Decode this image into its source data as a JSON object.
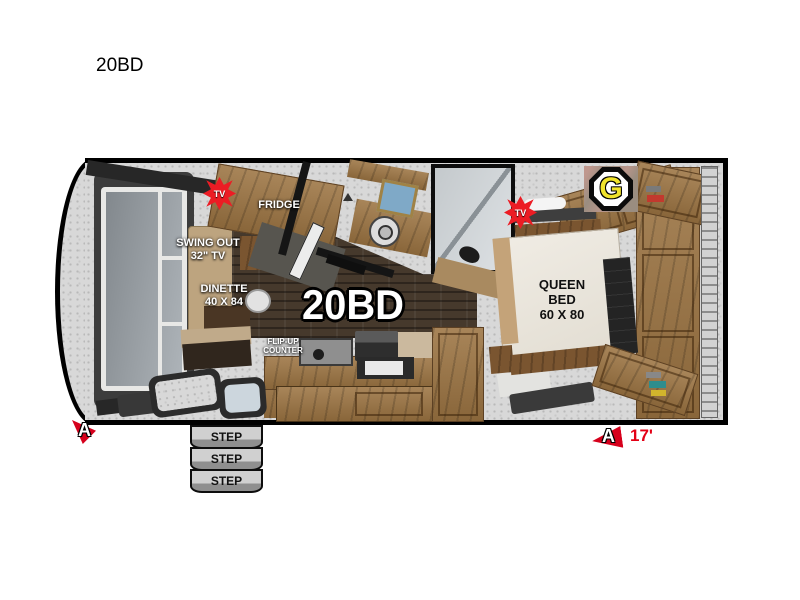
{
  "page": {
    "title": "20BD"
  },
  "floorplan": {
    "model_label": "20BD",
    "labels": {
      "fridge": "FRIDGE",
      "swing_tv_l1": "SWING OUT",
      "swing_tv_l2": "32\" TV",
      "dinette_l1": "DINETTE",
      "dinette_l2": "40 X 84",
      "flipup_l1": "FLIP-UP",
      "flipup_l2": "COUNTER",
      "queen_l1": "QUEEN",
      "queen_l2": "BED",
      "queen_l3": "60 X 80"
    },
    "badges": {
      "tv_front": "TV",
      "tv_bedroom": "TV",
      "brand": "G"
    },
    "markers": {
      "front_cam": "A",
      "rear_cam": "A",
      "rear_length": "17'"
    },
    "steps": [
      "STEP",
      "STEP",
      "STEP"
    ],
    "colors": {
      "accent_red": "#e3001b",
      "logo_yellow": "#f0e32c",
      "wood": "#9c7442",
      "outline": "#000000"
    }
  }
}
